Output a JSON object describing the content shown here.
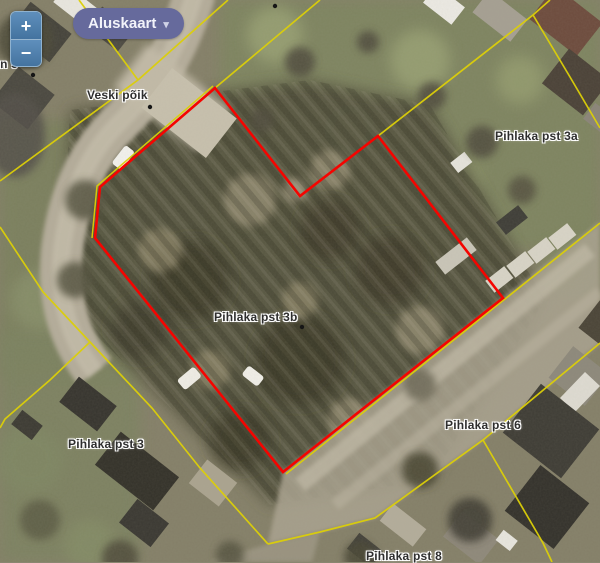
{
  "controls": {
    "zoom_in_label": "+",
    "zoom_out_label": "−",
    "basemap_button": {
      "label": "Aluskaart",
      "caret": "▾"
    }
  },
  "map": {
    "labels": [
      {
        "text": "ki tn 9"
      },
      {
        "text": "Veski põik"
      },
      {
        "text": "Pihlaka pst 3a"
      },
      {
        "text": "Pihlaka pst 3b"
      },
      {
        "text": "Pihlaka pst 3"
      },
      {
        "text": "Pihlaka pst 6"
      },
      {
        "text": "Pihlaka pst 8"
      }
    ],
    "selected_parcel_label": "Pihlaka pst 3b",
    "colors": {
      "parcel_highlight": "#f50400",
      "cadastral_line": "#dccf08",
      "basemap_button_bg": "#666a9c",
      "zoom_button_bg": "#4f80ae",
      "label_text": "#2e2e2e"
    }
  }
}
